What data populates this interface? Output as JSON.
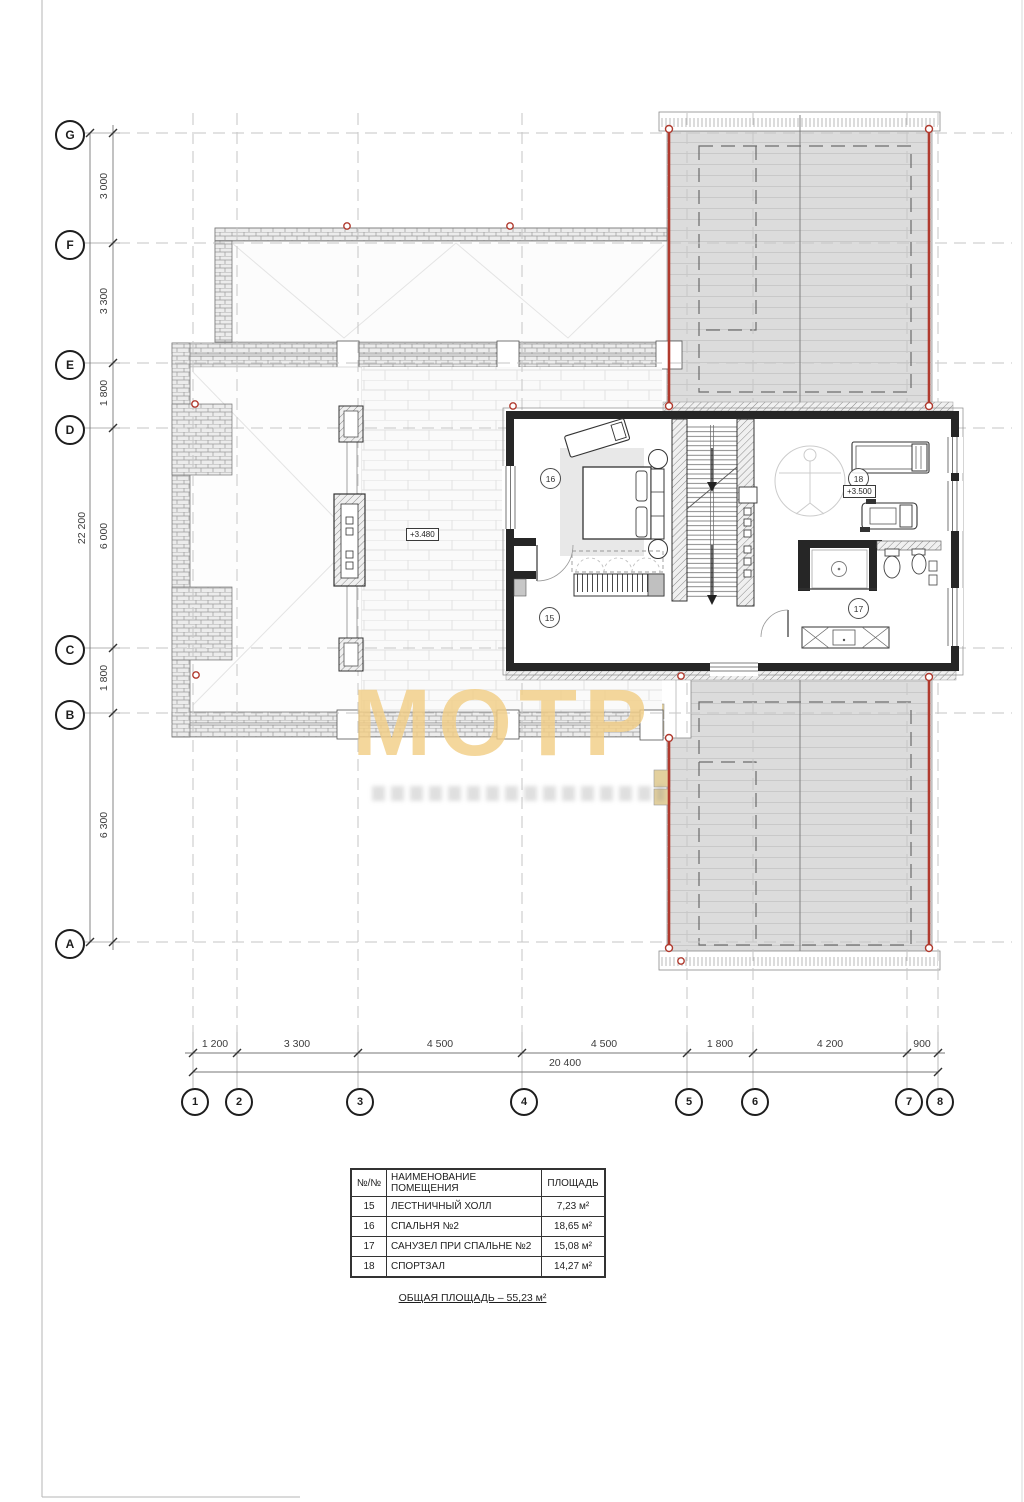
{
  "plan": {
    "watermark": "МОТР",
    "elevations": {
      "terrace": "+3.480",
      "gym": "+3.500"
    },
    "axes_left": [
      "G",
      "F",
      "E",
      "D",
      "C",
      "B",
      "A"
    ],
    "axes_bottom": [
      "1",
      "2",
      "3",
      "4",
      "5",
      "6",
      "7",
      "8"
    ],
    "dims_left": [
      "3 000",
      "3 300",
      "1 800",
      "6 000",
      "1 800",
      "6 300"
    ],
    "dim_left_total": "22 200",
    "dims_bottom": [
      "1 200",
      "3 300",
      "4 500",
      "4 500",
      "1 800",
      "4 200",
      "900"
    ],
    "dim_bottom_total": "20 400",
    "room_marks": [
      "16",
      "15",
      "18",
      "17"
    ]
  },
  "legend": {
    "headers": [
      "№/№",
      "НАИМЕНОВАНИЕ ПОМЕЩЕНИЯ",
      "ПЛОЩАДЬ"
    ],
    "rows": [
      {
        "num": "15",
        "name": "ЛЕСТНИЧНЫЙ ХОЛЛ",
        "area": "7,23 м²"
      },
      {
        "num": "16",
        "name": "СПАЛЬНЯ №2",
        "area": "18,65 м²"
      },
      {
        "num": "17",
        "name": "САНУЗЕЛ ПРИ СПАЛЬНЕ №2",
        "area": "15,08 м²"
      },
      {
        "num": "18",
        "name": "СПОРТЗАЛ",
        "area": "14,27 м²"
      }
    ],
    "total": "ОБЩАЯ ПЛОЩАДЬ – 55,23 м²"
  },
  "colors": {
    "red_accent": "#b03a2e",
    "roof_gray": "#dcdcdc",
    "watermark_tan": "#f2ce86"
  }
}
